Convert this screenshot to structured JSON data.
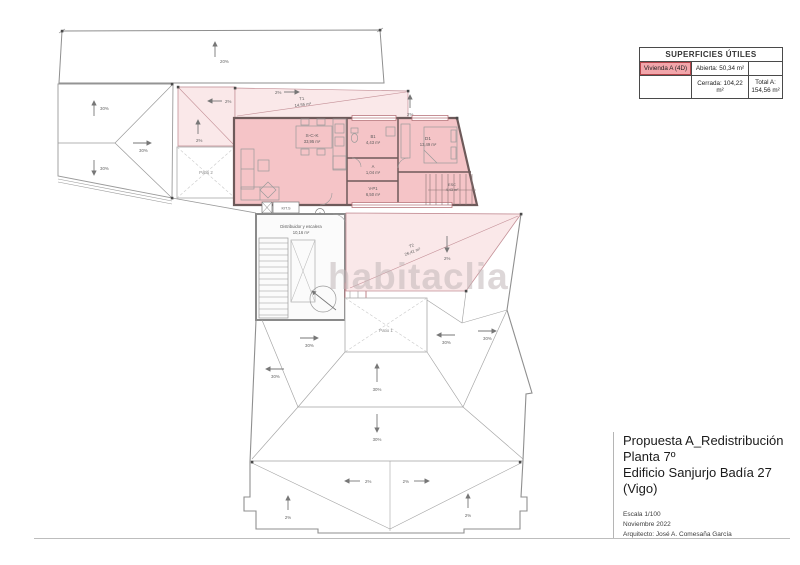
{
  "watermark": "habitaclia",
  "legend": {
    "title": "SUPERFICIES ÚTILES",
    "unit_label": "Vivienda A (4D)",
    "abierta": "Abierta: 50,34 m²",
    "cerrada": "Cerrada: 104,22 m²",
    "total_line1": "Total A:",
    "total_line2": "154,56 m²",
    "accent_color": "#f2a6ab"
  },
  "title_block": {
    "line1": "Propuesta A_Redistribución",
    "line2": "Planta 7º",
    "line3": "Edificio Sanjurjo Badía 27 (Vigo)",
    "escala": "Escala 1/100",
    "fecha": "Noviembre 2022",
    "arquitecto": "Arquitecto: José A. Comesaña García"
  },
  "plan": {
    "marker_a": "A",
    "slopes": {
      "top": "20%",
      "roof": "30%",
      "terrace": "2%"
    },
    "rooms": {
      "living": {
        "label": "S-C-K",
        "area": "33,95 m²"
      },
      "bath": {
        "label": "B1",
        "area": "4,43 m²"
      },
      "closet": {
        "label": "A",
        "area": "1,04 m²"
      },
      "vestibulo": {
        "label": "V-P1",
        "area": "6,50 m²"
      },
      "bedroom": {
        "label": "D1",
        "area": "13,49 m²"
      },
      "stairs": {
        "label": "ESC",
        "area": "4,43 m²"
      },
      "kit": {
        "label": "KIT.S"
      },
      "distribuidor": {
        "label": "Distribuidor y escalera",
        "area": "10,16 m²"
      },
      "terraza1": {
        "label": "T1",
        "area": "14,55 m²"
      },
      "terraza2": {
        "label": "T2",
        "area": "26,41 m²"
      },
      "patio1": {
        "label": "Patio 1"
      },
      "patio2": {
        "label": "Patio 2"
      }
    },
    "colors": {
      "apartment_fill": "#f5c4c7",
      "terrace_fill": "#fae8e9",
      "wall": "#6e5a5a",
      "accent_line": "#c49097",
      "drawing_line": "#8f8f8f"
    }
  }
}
